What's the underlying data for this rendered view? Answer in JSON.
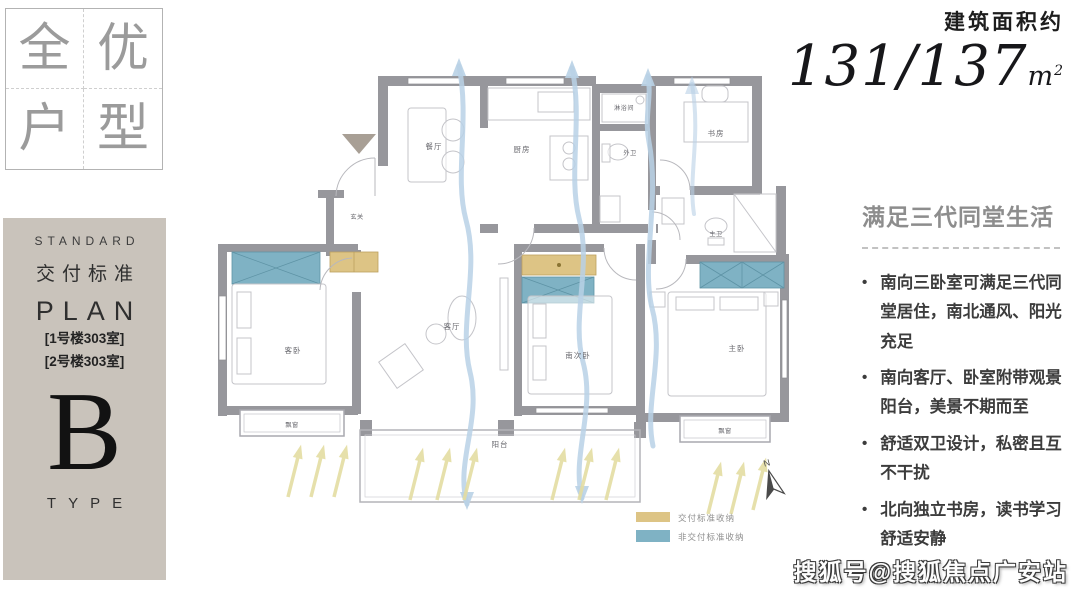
{
  "badge": {
    "chars": [
      "全",
      "优",
      "户",
      "型"
    ]
  },
  "banner": {
    "standard": "STANDARD",
    "title_cn": "交付标准",
    "plan": "PLAN",
    "room1": "[1号楼303室]",
    "room2": "[2号楼303室]",
    "letter": "B",
    "type": "TYPE"
  },
  "area": {
    "label": "建筑面积约",
    "value": "131/137",
    "unit_base": "m",
    "unit_sup": "2"
  },
  "highlights": {
    "title": "满足三代同堂生活",
    "bullets": [
      "南向三卧室可满足三代同堂居住，南北通风、阳光充足",
      "南向客厅、卧室附带观景阳台，美景不期而至",
      "舒适双卫设计，私密且互不干扰",
      "北向独立书房，读书学习舒适安静"
    ]
  },
  "floorplan": {
    "rooms": {
      "dining": "餐厅",
      "kitchen": "厨房",
      "shower": "淋浴间",
      "guest_bath": "外卫",
      "study": "书房",
      "master_bath": "主卫",
      "entry": "玄关",
      "living": "客厅",
      "guest_bed": "客卧",
      "south_bed": "南次卧",
      "master_bed": "主卧",
      "balcony": "阳台",
      "bay_left": "飘窗",
      "bay_right": "飘窗"
    },
    "compass": "N",
    "legend": [
      {
        "label": "交付标准收纳",
        "color": "#ddc485"
      },
      {
        "label": "非交付标准收纳",
        "color": "#7fb2c4"
      }
    ]
  },
  "watermark": {
    "text": "搜狐号@搜狐焦点广安站"
  },
  "colors": {
    "banner_bg": "#c9c3bb",
    "wall": "#97979c",
    "storage_gold": "#ddc485",
    "storage_blue": "#7fb2c4",
    "airflow_blue": "#b9d1e6",
    "sunlight_yellow": "#e4dda2"
  }
}
